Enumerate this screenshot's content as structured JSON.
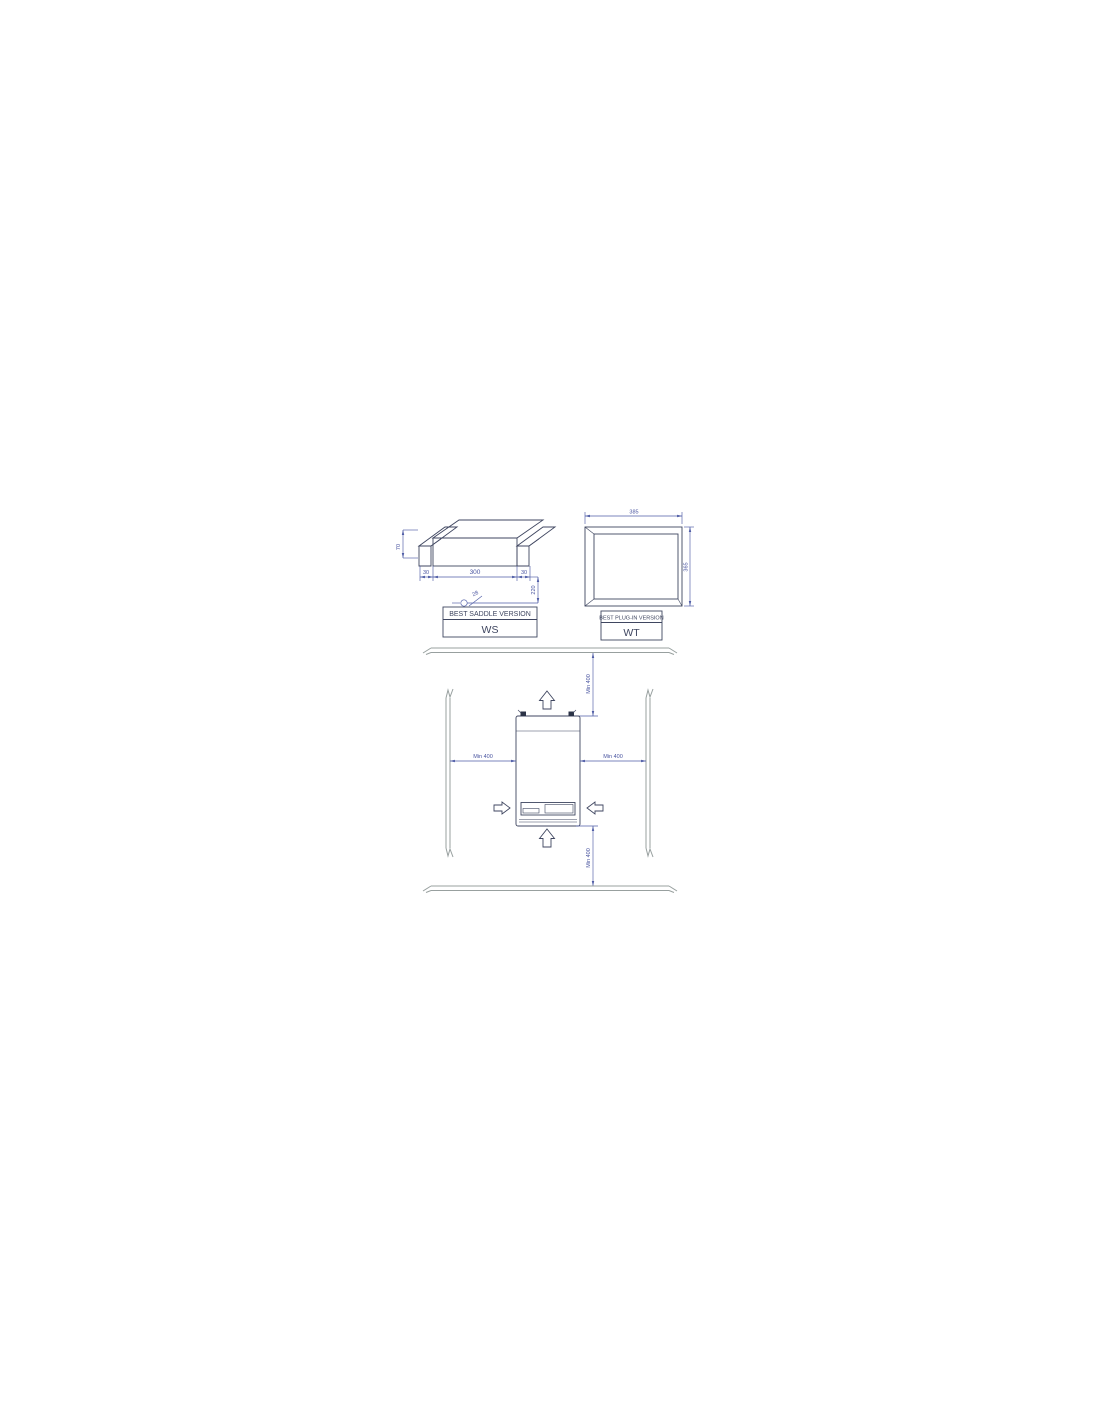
{
  "colors": {
    "object_line": "#3f4660",
    "dimension_line": "#4f5da6",
    "wall_line": "#98a09f",
    "background": "#ffffff"
  },
  "ws_view": {
    "label_title": "BEST SADDLE VERSION",
    "label_code": "WS",
    "dims": {
      "strap_height": "70",
      "left_flange": "30",
      "width": "300",
      "right_flange": "30",
      "depth": "220",
      "hole_note": "28"
    }
  },
  "wt_view": {
    "label_title": "BEST PLUG-IN VERSION",
    "label_code": "WT",
    "dims": {
      "width": "385",
      "height": "365"
    }
  },
  "clearance_view": {
    "top": "Min 400",
    "left": "Min 400",
    "right": "Min 400",
    "bottom": "Min 400"
  }
}
